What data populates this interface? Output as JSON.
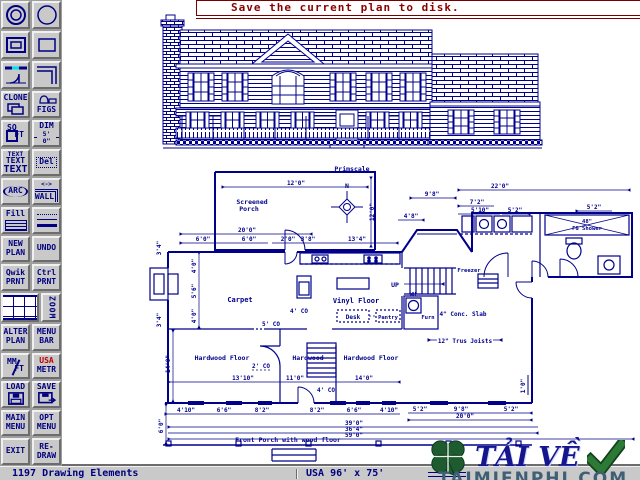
{
  "title_bar": {
    "message": "Save the current plan to disk."
  },
  "toolbar": {
    "clone": "CLONE",
    "figs": "FIGS",
    "sq": "SQ",
    "ft": "FT",
    "dim": "DIM",
    "dim_value": "5' 0\"",
    "text_small": "TEXT",
    "text_mid": "TEXT",
    "text_large": "TEXT",
    "del": "Del",
    "arc": "ARC",
    "wall_arrow": "<->",
    "wall": "WALL",
    "fill": "Fill",
    "new_plan": [
      "NEW",
      "PLAN"
    ],
    "undo": "UNDO",
    "qwik_prnt": [
      "Qwik",
      "PRNT"
    ],
    "ctrl_prnt": [
      "Ctrl",
      "PRNT"
    ],
    "zoom": "ZOOM",
    "alter_plan": [
      "ALTER",
      "PLAN"
    ],
    "menu_bar": [
      "MENU",
      "BAR"
    ],
    "mm": "MM",
    "ft2": "FT",
    "usa": "USA",
    "metr": "METR",
    "load": "LOAD",
    "save": "SAVE",
    "main_menu": [
      "MAIN",
      "MENU"
    ],
    "opt_menu": [
      "OPT",
      "MENU"
    ],
    "exit": "EXIT",
    "redraw": [
      "RE-",
      "DRAW"
    ]
  },
  "status_bar": {
    "left": "1197 Drawing Elements",
    "center": "USA 96' x 75'"
  },
  "watermark": {
    "download": "TẢI VỀ",
    "site": "TAIMIENPHI.COM"
  },
  "plan": {
    "labels": {
      "primscale": "Primscale",
      "north": "N",
      "screened_1": "Screened",
      "screened_2": "Porch",
      "carpet": "Carpet",
      "vinyl": "Vinyl Floor",
      "desk": "Desk",
      "pantry": "Pantry",
      "freezer": "Freezer",
      "up": "UP",
      "wh": "WH",
      "furn": "Furn",
      "slab": "4\" Conc. Slab",
      "joists": "12\" Trus Joists",
      "hw_left": "Hardwood Floor",
      "hw_mid": "Hardwood",
      "hw_right": "Hardwood Floor",
      "porch_front": "Front Porch with wood floor",
      "shower_1": "48\"",
      "shower_2": "FG Shower",
      "co_a": "4' CO",
      "co_b": "5' CO",
      "co_c": "2' CO",
      "co_d": "4' CO"
    },
    "dims": [
      "12'0\"",
      "12'0\"",
      "20'0\"",
      "6'0\"",
      "6'0\"",
      "2'0\"",
      "3'8\"",
      "13'4\"",
      "22'0\"",
      "9'8\"",
      "7'2\"",
      "5'10\"",
      "5'2\"",
      "5'2\"",
      "4'8\"",
      "3'4\"",
      "4'0\"",
      "5'6\"",
      "4'0\"",
      "3'4\"",
      "14'0\"",
      "6'0\"",
      "13'10\"",
      "11'0\"",
      "14'0\"",
      "4'10\"",
      "6'6\"",
      "8'2\"",
      "8'2\"",
      "6'6\"",
      "4'10\"",
      "5'2\"",
      "9'8\"",
      "5'2\"",
      "20'0\"",
      "39'0\"",
      "36'4\"",
      "59'0\"",
      "1'0\""
    ]
  },
  "colors": {
    "draw_navy": "#00008b",
    "accent_navy": "#000080",
    "maroon": "#7a0000",
    "red": "#c00000",
    "cyan": "#00e0ee",
    "wm_green": "#1e5c30",
    "wm_navy": "#15158e"
  }
}
